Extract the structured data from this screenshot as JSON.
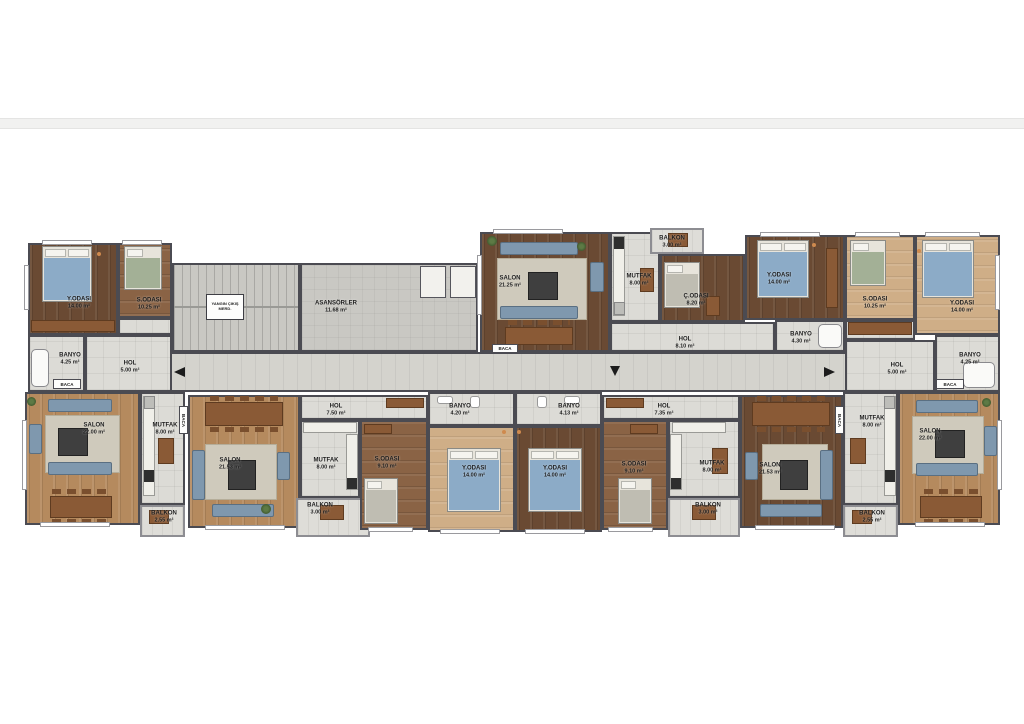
{
  "colors": {
    "wall": "#4b4b52",
    "tile_floor": "#dcdbd6",
    "corridor_floor": "#d4d3cd",
    "wood_dark": "#6a4a33",
    "wood_light": "#b58a5e",
    "sofa_blue": "#7f98ae",
    "bed_blanket_blue": "#8cabc7",
    "arrow_black": "#1c1c1c"
  },
  "labels": {
    "baca": {
      "name": "BACA"
    },
    "core_asansor": {
      "name": "ASANSÖRLER",
      "area": "11.68 m²"
    },
    "core_yangin": {
      "line1": "YANGIN ÇIKIŞ",
      "line2": "MERD."
    },
    "a_yodasi": {
      "name": "Y.ODASI",
      "area": "14.00 m²"
    },
    "a_sodasi": {
      "name": "S.ODASI",
      "area": "10.25 m²"
    },
    "a_banyo": {
      "name": "BANYO",
      "area": "4.25 m²"
    },
    "a_hol": {
      "name": "HOL",
      "area": "5.00 m²"
    },
    "a_salon": {
      "name": "SALON",
      "area": "22.00 m²"
    },
    "a_mutfak": {
      "name": "MUTFAK",
      "area": "8.00 m²"
    },
    "a_balkon": {
      "name": "BALKON",
      "area": "2.55 m²"
    },
    "b_salon": {
      "name": "SALON",
      "area": "21.25 m²"
    },
    "b_mutfak": {
      "name": "MUTFAK",
      "area": "8.00 m²"
    },
    "b_balkon": {
      "name": "BALKON",
      "area": "3.00 m²"
    },
    "b_codasi": {
      "name": "Ç.ODASI",
      "area": "8.20 m²"
    },
    "b_yodasi": {
      "name": "Y.ODASI",
      "area": "14.00 m²"
    },
    "b_banyo": {
      "name": "BANYO",
      "area": "4.30 m²"
    },
    "b_hol": {
      "name": "HOL",
      "area": "8.10 m²"
    },
    "c_sodasi": {
      "name": "S.ODASI",
      "area": "10.25 m²"
    },
    "c_yodasi": {
      "name": "Y.ODASI",
      "area": "14.00 m²"
    },
    "c_banyo": {
      "name": "BANYO",
      "area": "4.25 m²"
    },
    "c_hol": {
      "name": "HOL",
      "area": "5.00 m²"
    },
    "c_salon": {
      "name": "SALON",
      "area": "22.00 m²"
    },
    "c_mutfak": {
      "name": "MUTFAK",
      "area": "8.00 m²"
    },
    "c_balkon": {
      "name": "BALKON",
      "area": "2.55 m²"
    },
    "d_salon": {
      "name": "SALON",
      "area": "21.53 m²"
    },
    "d_hol": {
      "name": "HOL",
      "area": "7.50 m²"
    },
    "d_mutfak": {
      "name": "MUTFAK",
      "area": "8.00 m²"
    },
    "d_balkon": {
      "name": "BALKON",
      "area": "3.00 m²"
    },
    "d_banyo": {
      "name": "BANYO",
      "area": "4.20 m²"
    },
    "d_sodasi": {
      "name": "S.ODASI",
      "area": "9.10 m²"
    },
    "d_yodasi": {
      "name": "Y.ODASI",
      "area": "14.00 m²"
    },
    "e_banyo": {
      "name": "BANYO",
      "area": "4.13 m²"
    },
    "e_yodasi": {
      "name": "Y.ODASI",
      "area": "14.00 m²"
    },
    "e_sodasi": {
      "name": "S.ODASI",
      "area": "9.10 m²"
    },
    "e_hol": {
      "name": "HOL",
      "area": "7.35 m²"
    },
    "e_mutfak": {
      "name": "MUTFAK",
      "area": "8.00 m²"
    },
    "e_balkon": {
      "name": "BALKON",
      "area": "3.00 m²"
    },
    "e_salon": {
      "name": "SALON",
      "area": "21.53 m²"
    }
  }
}
